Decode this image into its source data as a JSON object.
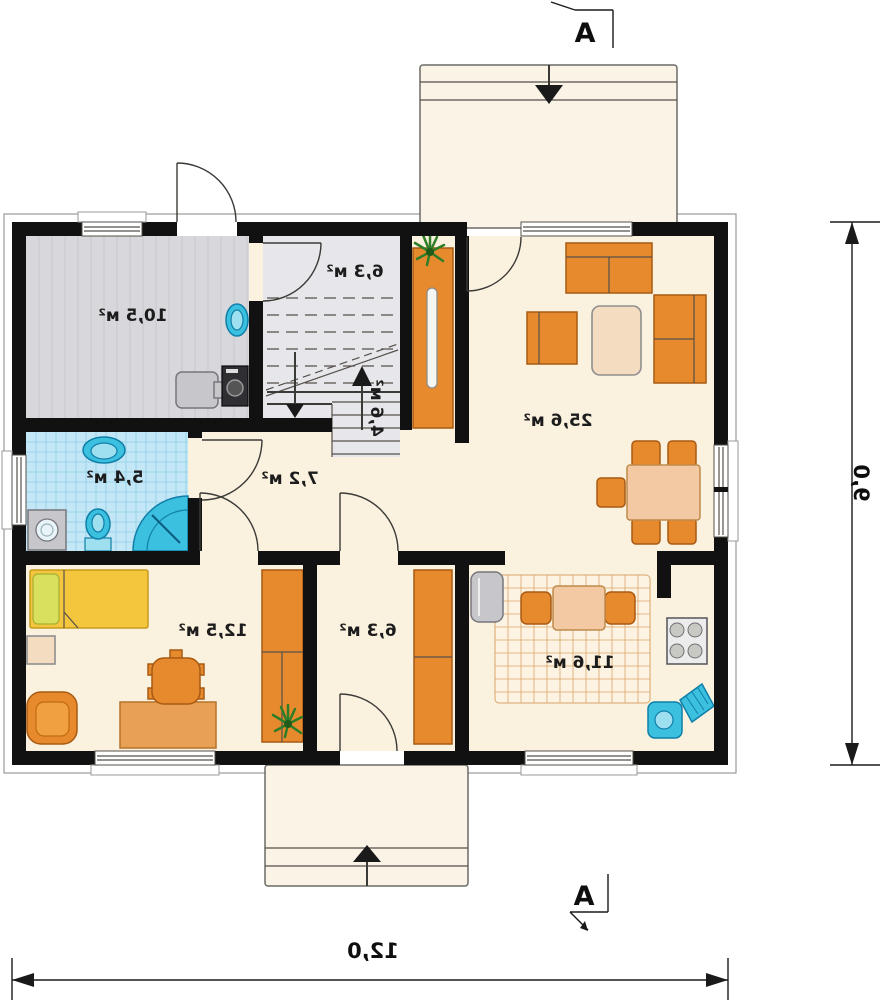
{
  "rooms": {
    "utility": {
      "label": "10,5 м²"
    },
    "stair_hall": {
      "label": "6,3 м²"
    },
    "stairs_lower": {
      "label": "4,6 м²"
    },
    "living": {
      "label": "25,6 м²"
    },
    "bathroom": {
      "label": "5,4 м²"
    },
    "hall": {
      "label": "7,2 м²"
    },
    "bedroom": {
      "label": "12,5 м²"
    },
    "corridor": {
      "label": "6,3 м²"
    },
    "kitchen": {
      "label": "11,6 м²"
    }
  },
  "dimensions": {
    "overall_width": "12,0",
    "overall_height": "9,0"
  },
  "section_markers": {
    "top": "A",
    "bottom": "A"
  },
  "colors": {
    "wall": "#111111",
    "floor": "#fbf1df",
    "porch": "#faf3e6",
    "utility_floor": "#d8d8dc",
    "stair_floor": "#e7e7eb",
    "bath_tile": "#c3e7f6",
    "bath_grid": "#8fcfe8",
    "rug_grid": "#d9a469",
    "furniture_orange": "#e78a2e",
    "furniture_orange_dark": "#a85a12",
    "wood": "#e8a055",
    "bed_yellow": "#f4c63e",
    "pillow_green": "#d8e05e",
    "fixture_blue": "#3bc0e0",
    "appliance_gray": "#c7c7cb",
    "plant_green": "#2f7d27",
    "dimension_ink": "#1a1a1a"
  }
}
